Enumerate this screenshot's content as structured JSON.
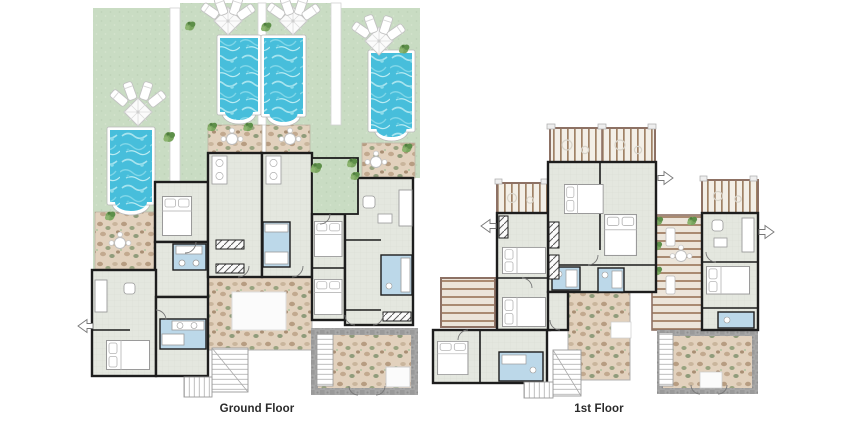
{
  "plans": {
    "ground": {
      "label": "Ground Floor"
    },
    "first": {
      "label": "1st Floor"
    }
  },
  "palette": {
    "background": "#ffffff",
    "lawn_green": "#c9dcc3",
    "path_white": "#ffffff",
    "pool_water": "#47bedb",
    "pool_water_light": "#a8e4ef",
    "room_floor": "#e4e7df",
    "wall_black": "#1d1d1d",
    "bathroom_blue": "#bcd8e9",
    "pebble_patio_tan": "#e2d1bd",
    "stone_border_gray": "#a7a7a7",
    "wood_plank_cream": "#f3efe7",
    "wood_frame_brown": "#8d7164",
    "deck_stripe_brown": "#aa8b72",
    "plant_green": "#6f9e57",
    "caption_text": "#2a2a2a"
  },
  "features": {
    "ground_floor": {
      "pools": 4,
      "parasol_lounger_sets": 4,
      "elements": [
        "lawned garden strips",
        "private pools",
        "parasols with sun loungers",
        "pebble patios with tables",
        "bedrooms",
        "bathrooms",
        "inner green court",
        "staircases",
        "rear cobble-edged terrace"
      ]
    },
    "first_floor": {
      "balconies": 4,
      "elements": [
        "wood-slat balconies with loungers",
        "timber sun deck with planters",
        "bedrooms",
        "bathrooms",
        "pebble roof terraces",
        "staircases"
      ]
    }
  }
}
